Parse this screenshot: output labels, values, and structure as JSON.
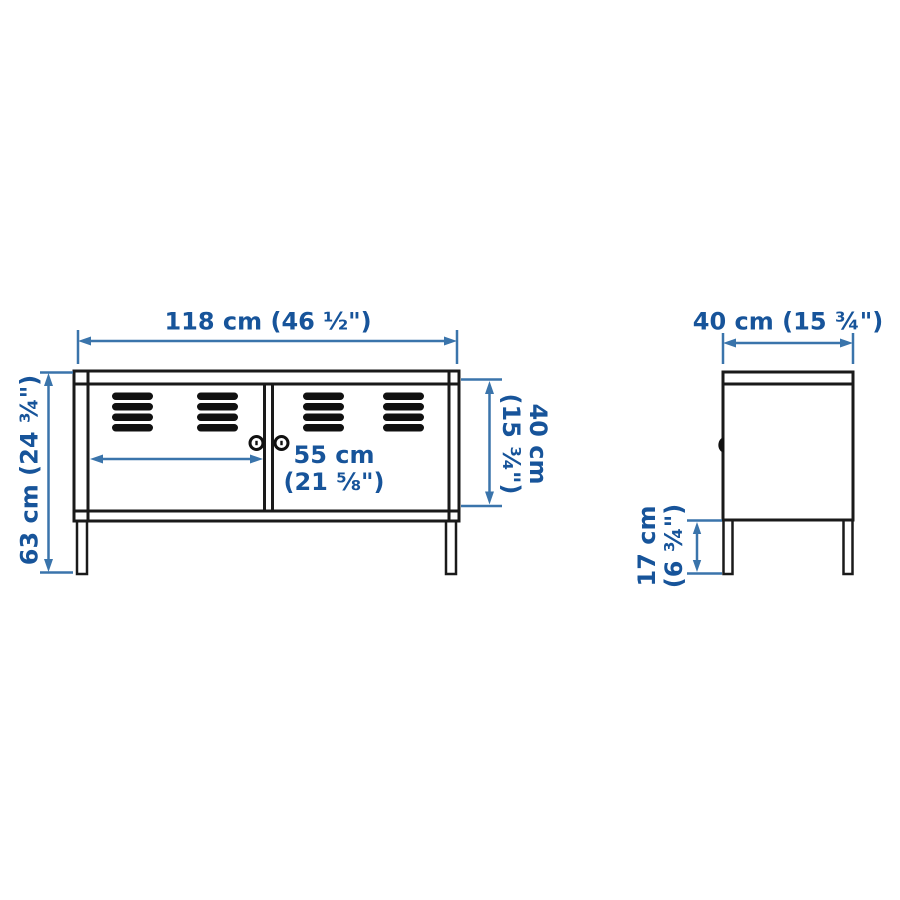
{
  "diagram": {
    "kind": "furniture-dimension-diagram",
    "subject": "two-door cabinet on legs, front view and side view",
    "colors": {
      "outline": "#1a1a1a",
      "dimension_line": "#3a74ab",
      "dimension_text": "#17549a",
      "background": "#ffffff"
    },
    "front_view": {
      "width_label": "118 cm (46 ½\")",
      "height_label": "63 cm (24 ¾\")",
      "door_width_label": {
        "line1": "55 cm",
        "line2": "(21 ⅝\")"
      },
      "body_height_label": {
        "line1": "40 cm",
        "line2": "(15 ¾\")"
      }
    },
    "side_view": {
      "depth_label": "40 cm (15 ¾\")",
      "leg_height_label": {
        "line1": "17 cm",
        "line2": "(6 ¾\")"
      }
    }
  }
}
